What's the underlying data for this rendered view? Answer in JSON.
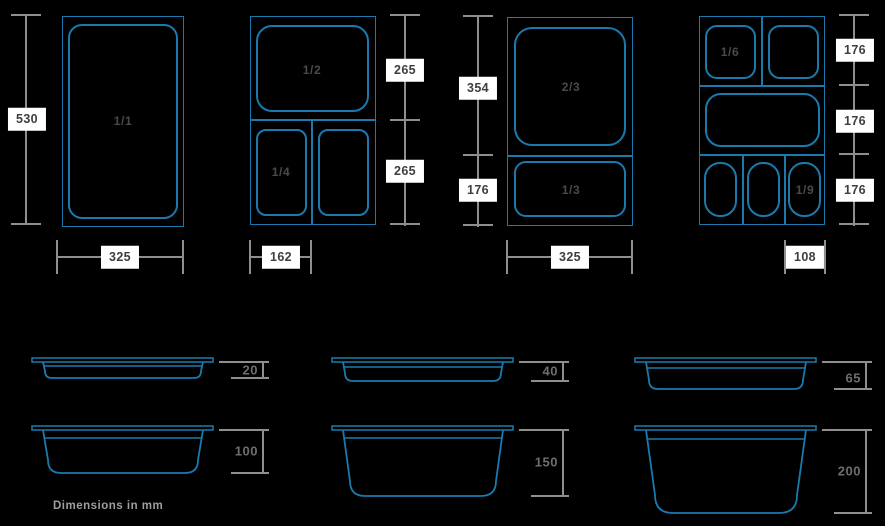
{
  "note": "Dimensions in mm",
  "colors": {
    "background": "#000000",
    "line_blue": "#1b7aad",
    "dim_gray": "#8e8e8e",
    "label_box_bg": "#ffffff",
    "label_box_text": "#3e3e3e",
    "pan_label_text": "#4a4a4a",
    "depth_label_text": "#6e6e6e",
    "footer_text": "#9e9e9e"
  },
  "top_views": [
    {
      "pan_labels": {
        "main": "1/1"
      },
      "dims": {
        "height": "530",
        "width": "325"
      }
    },
    {
      "pan_labels": {
        "top": "1/2",
        "bottom_left": "1/4"
      },
      "dims": {
        "right_top": "265",
        "right_bottom": "265",
        "width": "162"
      }
    },
    {
      "pan_labels": {
        "top": "2/3",
        "bottom": "1/3"
      },
      "dims": {
        "left_top": "354",
        "left_bottom": "176",
        "width": "325"
      }
    },
    {
      "pan_labels": {
        "top_left": "1/6",
        "bottom_right": "1/9"
      },
      "dims": {
        "right_1": "176",
        "right_2": "176",
        "right_3": "176",
        "width": "108"
      }
    }
  ],
  "side_views": [
    {
      "depth": "20"
    },
    {
      "depth": "40"
    },
    {
      "depth": "65"
    },
    {
      "depth": "100"
    },
    {
      "depth": "150"
    },
    {
      "depth": "200"
    }
  ]
}
